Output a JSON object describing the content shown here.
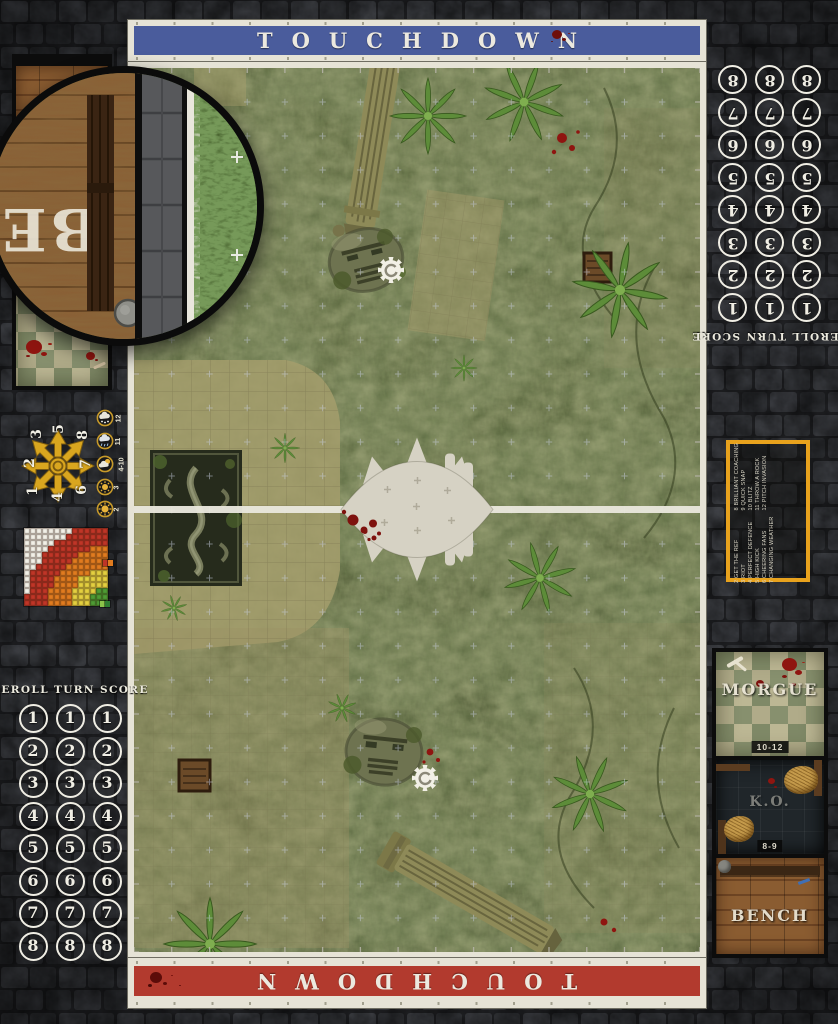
{
  "board_title": "Blood Bowl jungle ruins pitch game mat",
  "banners": {
    "top_label": "TOUCHDOWN",
    "bottom_label": "TOUCHDOWN"
  },
  "turn_track": {
    "header": "REROLL TURN SCORE",
    "numbers": [
      "1",
      "2",
      "3",
      "4",
      "5",
      "6",
      "7",
      "8"
    ]
  },
  "scatter_template": {
    "labels": [
      "1",
      "2",
      "3",
      "4",
      "5",
      "6",
      "7",
      "8"
    ]
  },
  "weather_table": {
    "entries": [
      {
        "value": "12",
        "icon": "snow-cloud-icon"
      },
      {
        "value": "11",
        "icon": "rain-cloud-icon"
      },
      {
        "value": "4-10",
        "icon": "sun-cloud-icon"
      },
      {
        "value": "3",
        "icon": "sun-icon"
      },
      {
        "value": "2",
        "icon": "sun-icon"
      }
    ]
  },
  "range_ruler": {
    "cols": 14,
    "rows": 13,
    "radii": {
      "quick": 3.3,
      "short": 6.4,
      "long": 9.9,
      "bomb": 13.7
    },
    "colors": {
      "quick": "#4e9b34",
      "short": "#e3cf3f",
      "long": "#e07b1f",
      "bomb": "#bf3527",
      "out": "#f2efe6"
    },
    "legend_chips": [
      [
        "#bf3527",
        "#e07b1f"
      ],
      [
        "#8bc34a",
        "#2f7d32"
      ]
    ]
  },
  "kickoff_table": {
    "entries": [
      "2 GET THE REF",
      "3 RIOT",
      "4 PERFECT DEFENCE",
      "5 HIGH KICK",
      "6 CHEERING FANS",
      "7 CHANGING WEATHER",
      "8 BRILLIANT COACHING",
      "9 QUICK SNAP",
      "10 BLITZ",
      "11 THROW A ROCK",
      "12 PITCH INVASION"
    ]
  },
  "dugout": {
    "morgue_label": "MORGUE",
    "morgue_range": "10-12",
    "ko_label": "K.O.",
    "ko_range": "8-9",
    "bench_label": "BENCH"
  },
  "magnifier": {
    "letters": "BE"
  },
  "colors": {
    "banner_top": "#4a5c9c",
    "banner_bottom": "#b23a2e",
    "frame": "#e6e3d6",
    "scatter_gold": "#d9a61f",
    "kickoff_border": "#e8a21d"
  }
}
